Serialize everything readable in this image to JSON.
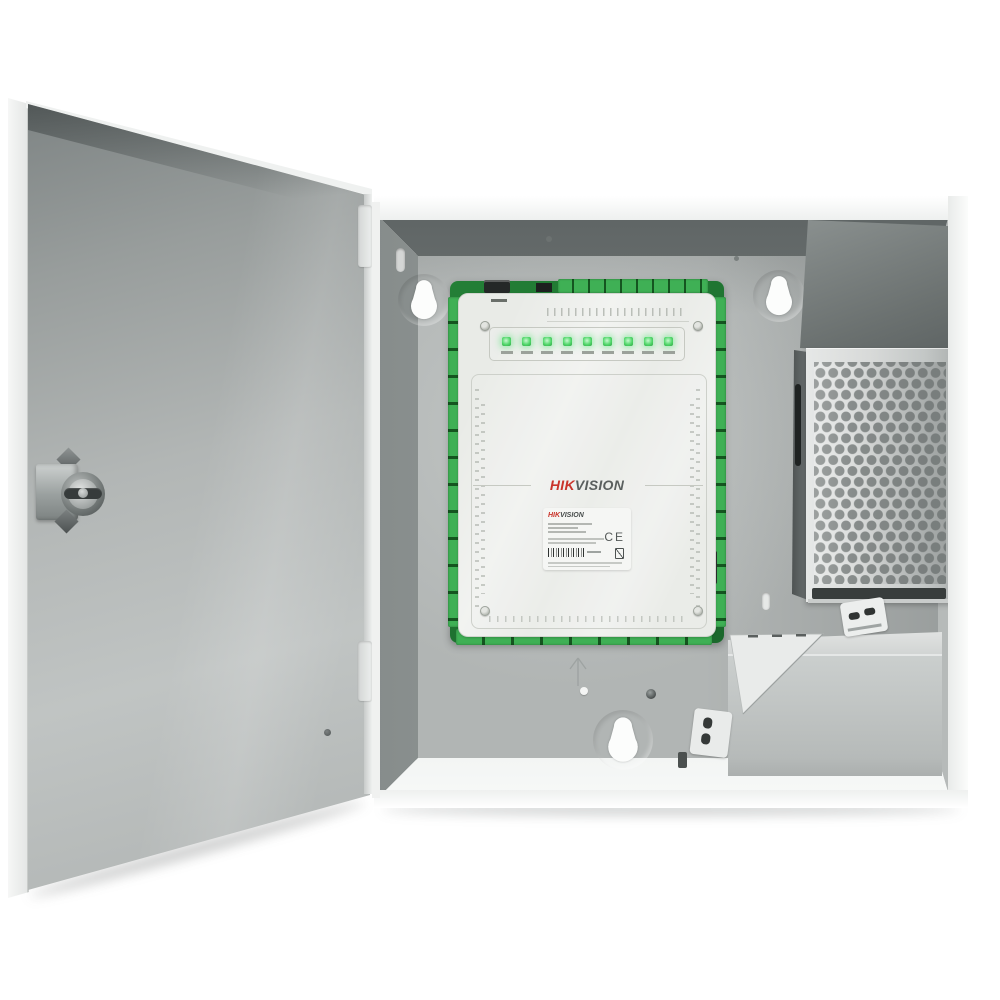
{
  "board": {
    "led_count": 9,
    "logo": {
      "prefix": "HIK",
      "suffix": "VISION"
    }
  },
  "sticker": {
    "logo_prefix": "HIK",
    "logo_suffix": "VISION",
    "ce_mark": "CE"
  },
  "colors": {
    "brand_red": "#c9342b",
    "pcb_green": "#237f36",
    "terminal_green": "#3fb055",
    "led_green": "#52d86b",
    "cabinet_gray": "#b1b5b4",
    "door_gray": "#b2b6b5",
    "psu_metal": "#d7d9d8",
    "psu_hole_gray": "#878c8b"
  }
}
